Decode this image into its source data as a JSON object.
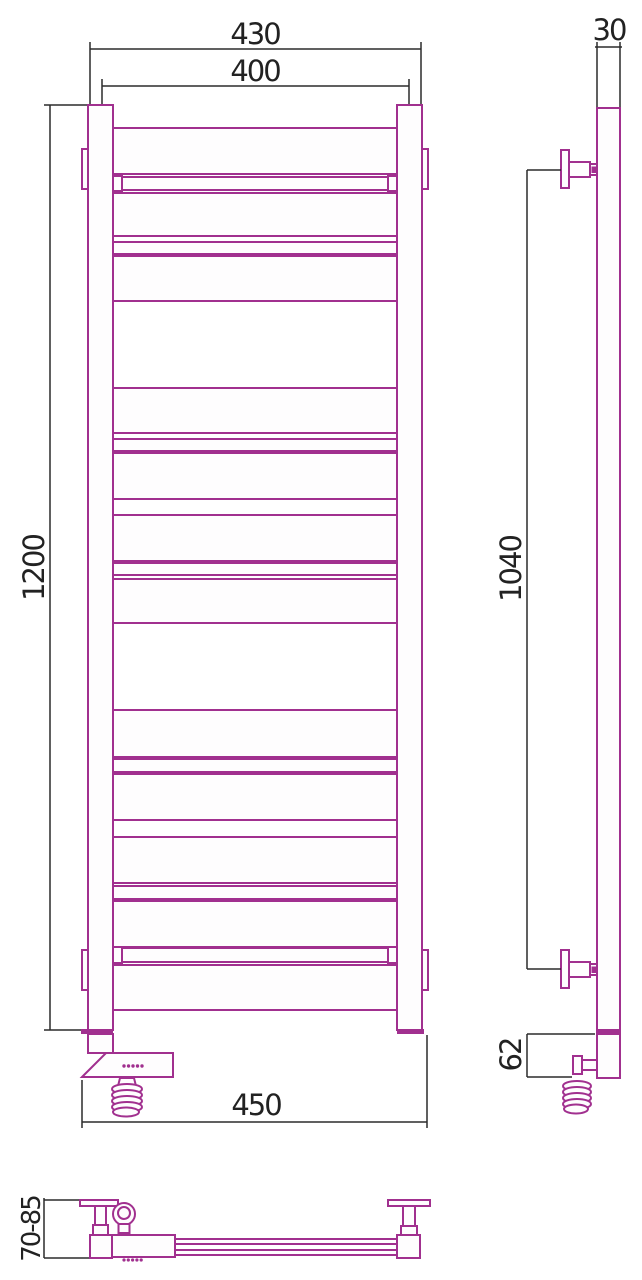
{
  "colors": {
    "outline": "#a1308f",
    "dimension": "#2b2b2b"
  },
  "dimensions": {
    "front": {
      "overall_width": "430",
      "pipe_centers_width": "400",
      "height": "1200",
      "bottom_overall_width": "450"
    },
    "side": {
      "depth": "30",
      "bracket_span": "1040",
      "heater_box_height": "62"
    },
    "top": {
      "wall_clearance": "70-85"
    }
  },
  "drawing": {
    "front_geometry": {
      "x": 113,
      "w": 284,
      "tab_w": 9
    },
    "front_rungs": [
      {
        "y": 128,
        "h": 46,
        "type": "wide"
      },
      {
        "y": 177,
        "h": 13,
        "type": "tab"
      },
      {
        "y": 193,
        "h": 43,
        "type": "wide"
      },
      {
        "y": 242,
        "h": 12,
        "type": "narrow"
      },
      {
        "y": 256,
        "h": 45,
        "type": "wide"
      },
      {
        "y": 388,
        "h": 45,
        "type": "wide"
      },
      {
        "y": 439,
        "h": 12,
        "type": "narrow"
      },
      {
        "y": 453,
        "h": 46,
        "type": "wide"
      },
      {
        "y": 515,
        "h": 46,
        "type": "wide"
      },
      {
        "y": 563,
        "h": 12,
        "type": "narrow"
      },
      {
        "y": 579,
        "h": 44,
        "type": "wide"
      },
      {
        "y": 710,
        "h": 47,
        "type": "wide"
      },
      {
        "y": 759,
        "h": 13,
        "type": "narrow"
      },
      {
        "y": 774,
        "h": 46,
        "type": "wide"
      },
      {
        "y": 837,
        "h": 46,
        "type": "wide"
      },
      {
        "y": 886,
        "h": 13,
        "type": "narrow"
      },
      {
        "y": 901,
        "h": 46,
        "type": "wide"
      },
      {
        "y": 948,
        "h": 14,
        "type": "tab"
      },
      {
        "y": 965,
        "h": 45,
        "type": "wide"
      }
    ]
  }
}
